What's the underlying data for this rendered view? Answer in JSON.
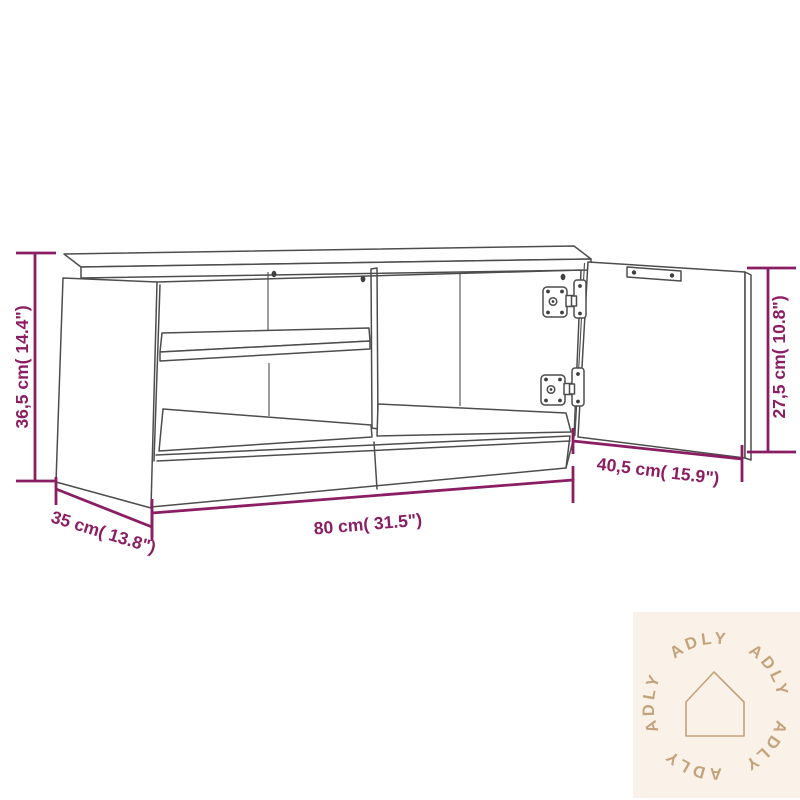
{
  "image": {
    "kind": "product-dimension-diagram",
    "subject": "TV cabinet line drawing with open left compartment, middle shelf, base rail and open right door with hinges",
    "background": "#ffffff",
    "line_color": "#4d4d4d",
    "accent_color": "#8b1e63"
  },
  "dimensions": {
    "height": "36,5 cm( 14.4\")",
    "width": "80 cm( 31.5\")",
    "depth": "35 cm( 13.8\")",
    "door_height": "27,5 cm( 10.8\")",
    "door_width": "40,5 cm( 15.9\")"
  },
  "watermark": {
    "brand": "ADLY",
    "ring": [
      "ADLY",
      "ADLY",
      "ADLY",
      "ADLY",
      "ADLY"
    ],
    "bg_color": "#faf1e9",
    "accent_color": "#c2a37b"
  }
}
